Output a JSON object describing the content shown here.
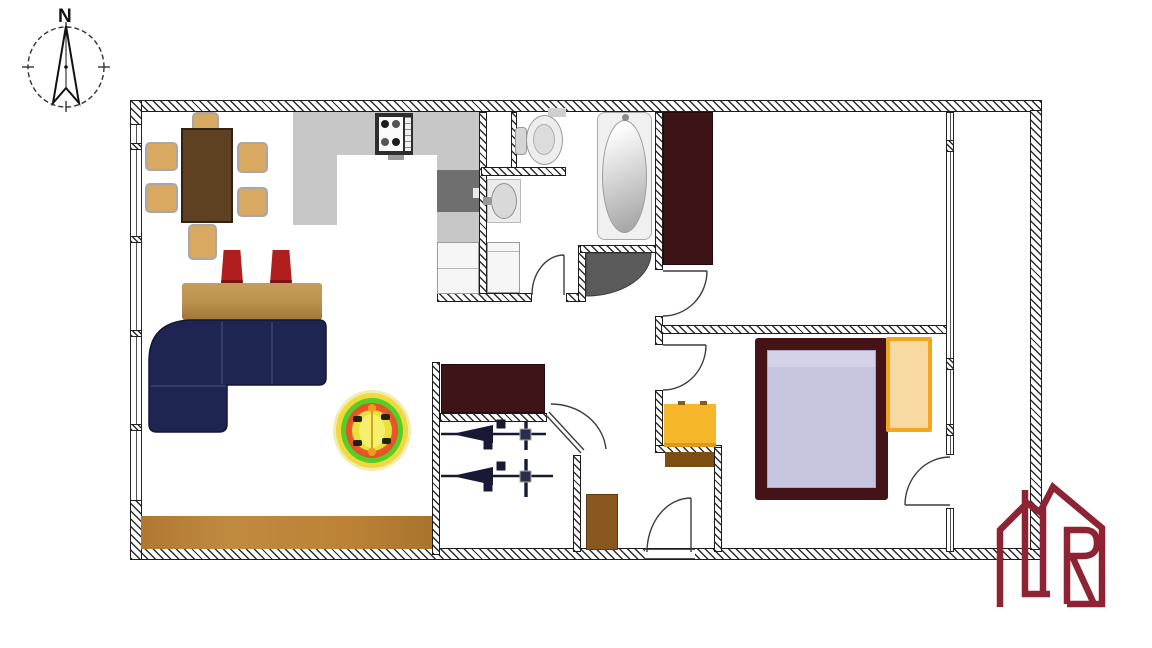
{
  "compass": {
    "label": "N"
  },
  "logo": {
    "letter": "R",
    "color": "#8e2433"
  },
  "plan": {
    "background": "#ffffff",
    "wall_color": "#1c1c1c",
    "rooms_visible": 9
  },
  "legend": {
    "kitchen_counter": "#c7c7c7",
    "kitchen_sink_cabinet": "#6f6f6f",
    "stove": "#2e2e2e",
    "appliance_white": "#f6f6f6",
    "dining_table": "#5e4023",
    "dining_chair": "#d9a962",
    "bar_counter": "#b9904c",
    "bar_stool": "#b01e1e",
    "sofa": "#1f2553",
    "rug_ring_outer": "#f3ecae",
    "rug_ring_yellow": "#f0d93c",
    "rug_ring_green": "#55cf28",
    "rug_ring_red": "#e25227",
    "rug_center": "#e9e03e",
    "wood_floor": "#bd8236",
    "wardrobe": "#3c1317",
    "bed_frame": "#441317",
    "bed_mattress": "#c6c5df",
    "nightstand_border": "#f2a51d",
    "nightstand_fill": "#f8d9a2",
    "dresser_yellow": "#f5b729",
    "cabinet_brown": "#8a5620",
    "door_shadow": "#5b5b5b",
    "stair_arrow": "#191935",
    "bathtub": "#f0f0f0"
  }
}
